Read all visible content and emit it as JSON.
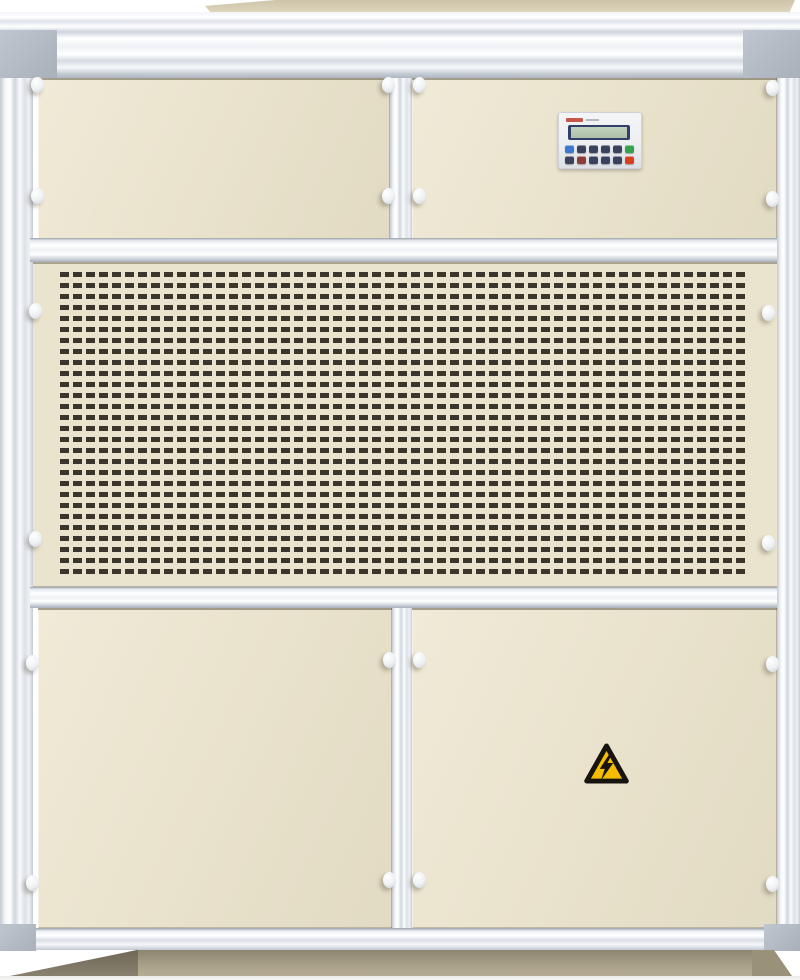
{
  "meta": {
    "description": "Photograph of a beige industrial air-handling / dehumidifier cabinet with aluminium frame, perforated air-intake grille, LCD controller keypad and a high-voltage warning sticker",
    "image_width": 800,
    "image_height": 980
  },
  "theme": {
    "panel-cream": "#eae3cd",
    "panel-cream-light": "#f0ead8",
    "panel-cream-dark": "#e2dbc3",
    "grille-hole": "#3a362b",
    "controller-face": "#eceef1",
    "logo-red": "#c0392b",
    "lcd-frame": "#31406a",
    "lcd-screen": "#c2d2bd",
    "key-dark": "#39415c",
    "key-blue": "#3d77d2",
    "key-green": "#35a34c",
    "key-red": "#d6401f",
    "key-maroon": "#8c3a3a",
    "hazard-yellow": "#f5bd02",
    "hazard-black": "#17140e"
  },
  "grille": {
    "pitch_x": 13,
    "pitch_y": 11,
    "hole_w": 9,
    "hole_h": 5,
    "columns": 52,
    "rows": 28
  },
  "controller": {
    "display_state": "blank",
    "button_rows": [
      [
        "blue",
        "dark",
        "dark",
        "dark",
        "dark",
        "green"
      ],
      [
        "dark",
        "maroon",
        "dark",
        "dark",
        "dark",
        "red"
      ]
    ]
  },
  "warning_sticker": {
    "icon": "high-voltage-icon",
    "meaning": "electrical hazard"
  }
}
